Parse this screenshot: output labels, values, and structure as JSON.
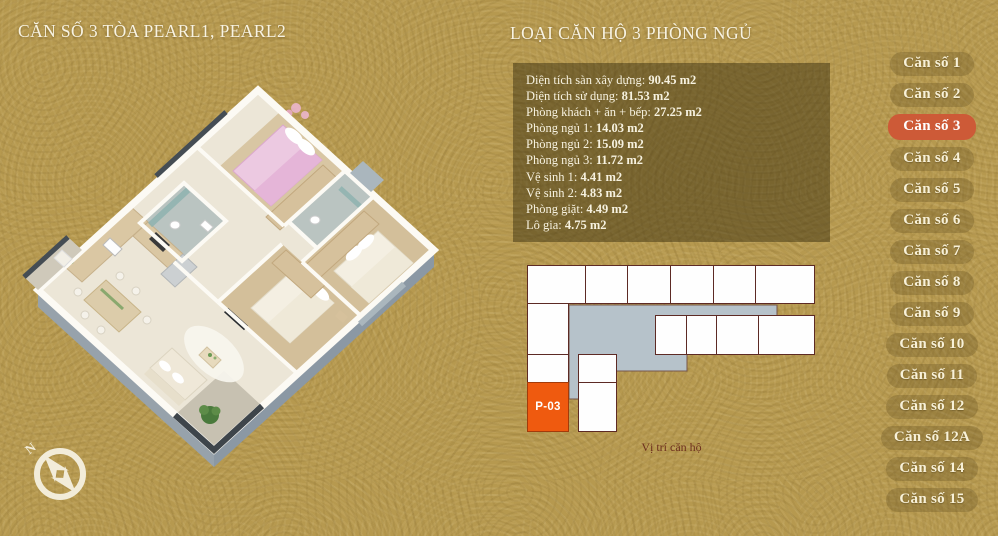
{
  "header": {
    "title_left": "CĂN SỐ 3 TÒA PEARL1, PEARL2",
    "title_right": "LOẠI CĂN HỘ 3 PHÒNG NGỦ"
  },
  "info_panel": {
    "rows": [
      {
        "label": "Diện tích sàn xây dựng:",
        "value": "90.45 m2"
      },
      {
        "label": "Diện tích sử dụng:",
        "value": "81.53 m2"
      },
      {
        "label": "Phòng khách + ăn + bếp:",
        "value": "27.25 m2"
      },
      {
        "label": "Phòng ngủ 1:",
        "value": "14.03 m2"
      },
      {
        "label": "Phòng ngủ 2:",
        "value": "15.09 m2"
      },
      {
        "label": "Phòng ngủ 3:",
        "value": "11.72 m2"
      },
      {
        "label": "Vệ sinh 1:",
        "value": "4.41 m2"
      },
      {
        "label": "Vệ sinh 2:",
        "value": "4.83 m2"
      },
      {
        "label": "Phòng giặt:",
        "value": "4.49 m2"
      },
      {
        "label": "Lô gia:",
        "value": "4.75 m2"
      }
    ]
  },
  "unit_map": {
    "active_unit_label": "P-03",
    "caption": "Vị trí căn hộ"
  },
  "sidebar": {
    "active_index": 2,
    "items": [
      {
        "label": "Căn số 1"
      },
      {
        "label": "Căn số 2"
      },
      {
        "label": "Căn số 3"
      },
      {
        "label": "Căn số 4"
      },
      {
        "label": "Căn số 5"
      },
      {
        "label": "Căn số 6"
      },
      {
        "label": "Căn số 7"
      },
      {
        "label": "Căn số 8"
      },
      {
        "label": "Căn số 9"
      },
      {
        "label": "Căn số 10"
      },
      {
        "label": "Căn số 11"
      },
      {
        "label": "Căn số 12"
      },
      {
        "label": "Căn số 12A"
      },
      {
        "label": "Căn số 14"
      },
      {
        "label": "Căn số 15"
      }
    ]
  },
  "compass": {
    "north_label": "N"
  },
  "colors": {
    "background": "#b6994f",
    "active_button": "#cd5a37",
    "active_unit": "#ef5a0f",
    "map_corridor_gray": "#b6c2ca",
    "map_border": "#5d2a24",
    "panel_overlay": "rgba(47,37,9,0.45)",
    "title_text": "#f8f3e2",
    "caption_text": "#6d2f1e"
  }
}
